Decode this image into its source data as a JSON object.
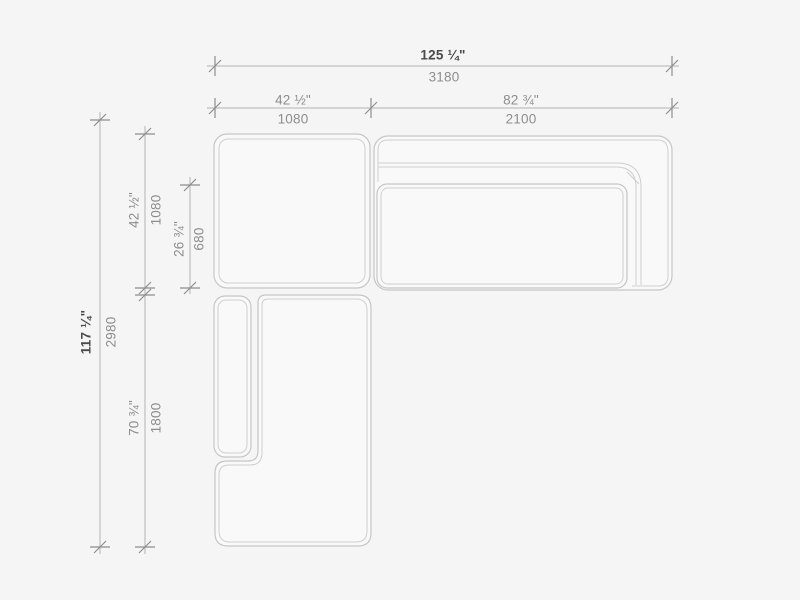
{
  "dimensions": {
    "overall_width": {
      "inches": "125 ¼\"",
      "mm": "3180"
    },
    "left_section_width": {
      "inches": "42 ½\"",
      "mm": "1080"
    },
    "right_section_width": {
      "inches": "82 ¾\"",
      "mm": "2100"
    },
    "overall_depth": {
      "inches": "117 ¼\"",
      "mm": "2980"
    },
    "corner_section_depth": {
      "inches": "42 ½\"",
      "mm": "1080"
    },
    "seat_depth": {
      "inches": "26 ¾\"",
      "mm": "680"
    },
    "chaise_length": {
      "inches": "70 ¾\"",
      "mm": "1800"
    }
  },
  "colors": {
    "background": "#f5f5f5",
    "furniture_outline": "#c6c6c6",
    "dimension_line": "#b3b3b3",
    "tick_mark": "#8e8e8e",
    "label_primary": "#4a4a4a",
    "label_secondary": "#8d8d8d"
  }
}
